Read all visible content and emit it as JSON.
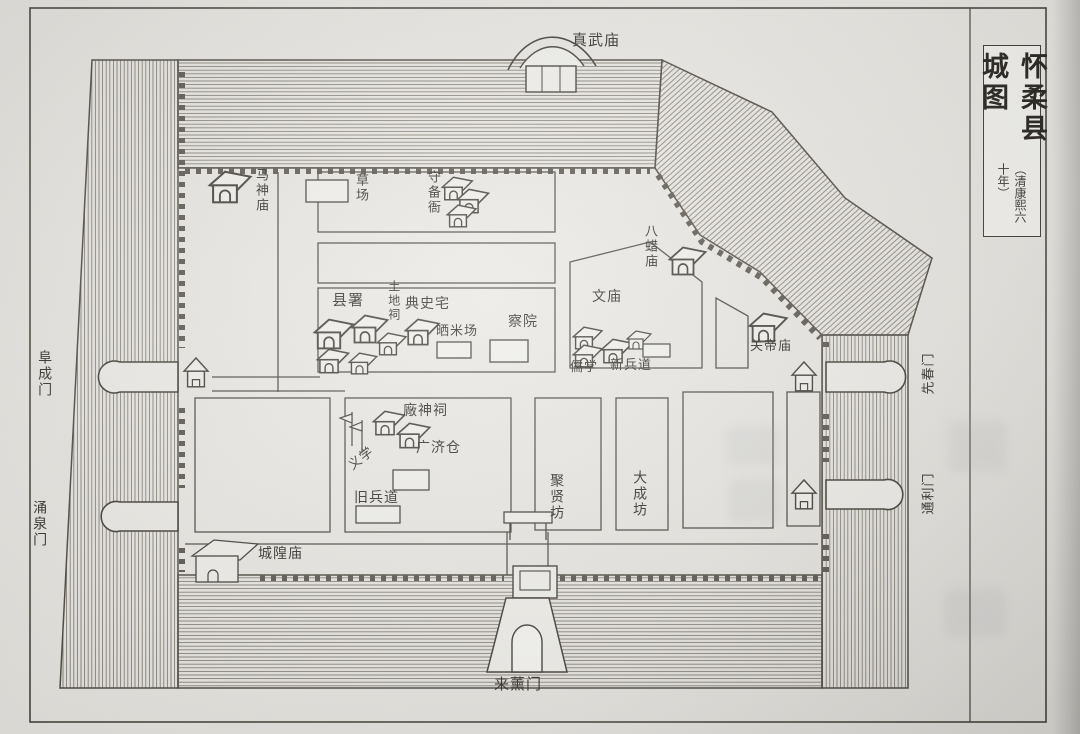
{
  "map": {
    "title": "怀柔县城图",
    "title_note": "（清康熙六十年）",
    "gates": {
      "north_wall_temple": "真武庙",
      "west": "阜成门",
      "southwest": "涌泉门",
      "south": "来薰门",
      "east_upper": "先春门",
      "east_lower": "通利门"
    },
    "places": {
      "horse_god_temple": "马神庙",
      "grass_yard": "草场",
      "garrison_office": "守备衙",
      "bazha_temple": "八蜡庙",
      "county_office": "县署",
      "earth_god_shrine": "土地祠",
      "registrar_residence": "典史宅",
      "rice_drying_yard": "晒米场",
      "inspection_court": "察院",
      "confucian_temple": "文庙",
      "confucian_school": "儒学",
      "new_military_circuit": "新兵道",
      "guandi_temple": "关帝庙",
      "chang_god_shrine": "廠神祠",
      "guangji_granary": "广济仓",
      "charity_school": "义学",
      "old_military_circuit": "旧兵道",
      "juxian_arch": "聚贤坊",
      "dacheng_arch": "大成坊",
      "city_god_temple": "城隍庙"
    }
  }
}
